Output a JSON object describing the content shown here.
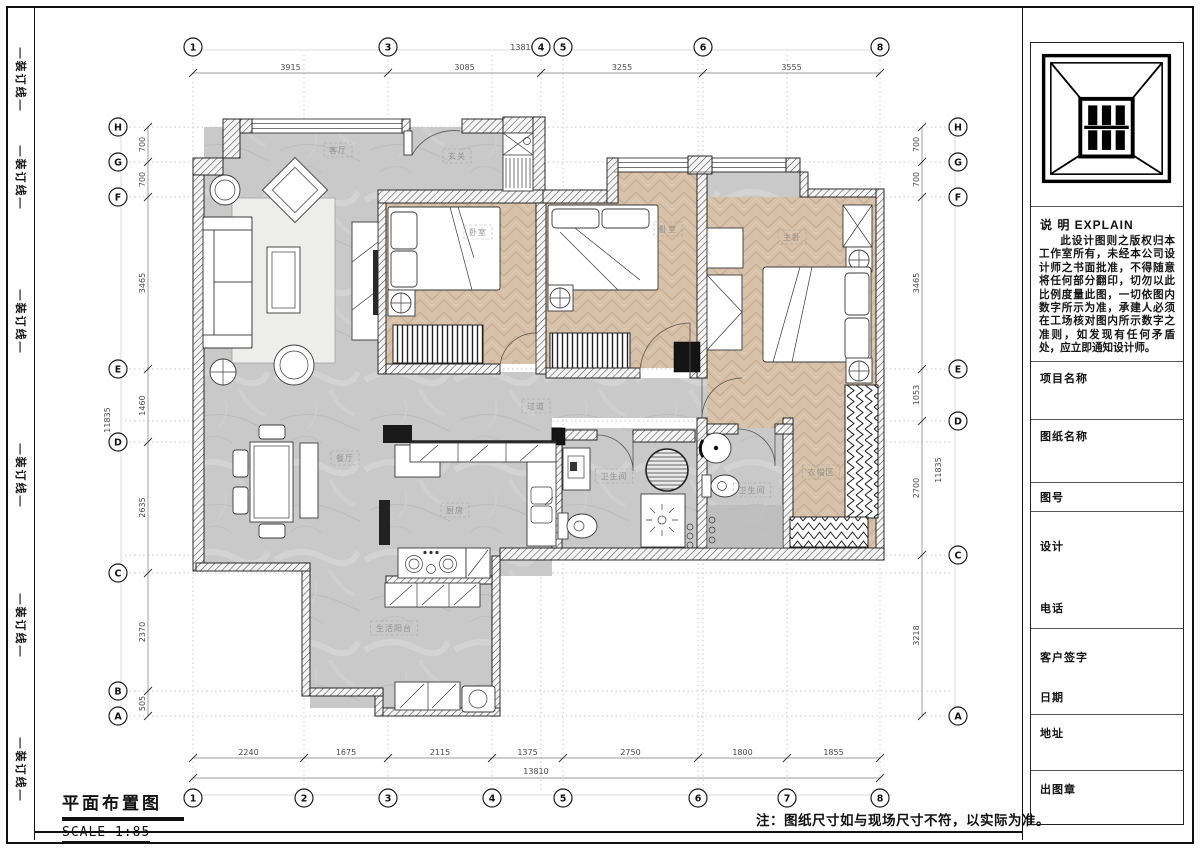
{
  "page": {
    "note": "注：图纸尺寸如与现场尺寸不符，以实际为准。"
  },
  "binding": {
    "label": "—装订线—",
    "positions_y": [
      80,
      178,
      322,
      476,
      626,
      770
    ]
  },
  "title_block": {
    "title": "平面布置图",
    "scale": "SCALE 1:85"
  },
  "panel": {
    "explain_title": "说 明 EXPLAIN",
    "explain_text": "此设计图则之版权归本工作室所有，未经本公司设计师之书面批准，不得随意将任何部分翻印，切勿以此比例度量此图，一切依图内数字所示为准，承建人必须在工场核对图内所示数字之准则，如发现有任何矛盾处，应立即通知设计师。",
    "fields": [
      "项目名称",
      "图纸名称",
      "图号",
      "设计",
      "电话",
      "客户签字",
      "日期",
      "地址",
      "出图章"
    ]
  },
  "plan": {
    "grid_v": [
      193,
      304,
      388,
      492,
      541,
      563,
      698,
      703,
      787,
      880
    ],
    "grid_v_span": [
      55,
      790
    ],
    "grid_h": [
      127,
      162,
      197,
      369,
      421,
      442,
      555,
      573,
      691,
      716
    ],
    "grid_h_span": [
      125,
      950
    ],
    "axis_lines": [
      {
        "x1": 183,
        "y1": 50,
        "x2": 892,
        "y2": 50
      },
      {
        "x1": 183,
        "y1": 795,
        "x2": 892,
        "y2": 795
      },
      {
        "x1": 121,
        "y1": 114,
        "x2": 121,
        "y2": 728
      },
      {
        "x1": 955,
        "y1": 114,
        "x2": 955,
        "y2": 728
      }
    ],
    "bubbles": [
      {
        "x": 193,
        "y": 47,
        "label": "1"
      },
      {
        "x": 388,
        "y": 47,
        "label": "3"
      },
      {
        "x": 541,
        "y": 47,
        "label": "4"
      },
      {
        "x": 563,
        "y": 47,
        "label": "5"
      },
      {
        "x": 703,
        "y": 47,
        "label": "6"
      },
      {
        "x": 880,
        "y": 47,
        "label": "8"
      },
      {
        "x": 193,
        "y": 798,
        "label": "1"
      },
      {
        "x": 304,
        "y": 798,
        "label": "2"
      },
      {
        "x": 388,
        "y": 798,
        "label": "3"
      },
      {
        "x": 492,
        "y": 798,
        "label": "4"
      },
      {
        "x": 563,
        "y": 798,
        "label": "5"
      },
      {
        "x": 698,
        "y": 798,
        "label": "6"
      },
      {
        "x": 787,
        "y": 798,
        "label": "7"
      },
      {
        "x": 880,
        "y": 798,
        "label": "8"
      },
      {
        "x": 118,
        "y": 127,
        "label": "H"
      },
      {
        "x": 118,
        "y": 162,
        "label": "G"
      },
      {
        "x": 118,
        "y": 197,
        "label": "F"
      },
      {
        "x": 118,
        "y": 369,
        "label": "E"
      },
      {
        "x": 118,
        "y": 442,
        "label": "D"
      },
      {
        "x": 118,
        "y": 573,
        "label": "C"
      },
      {
        "x": 118,
        "y": 691,
        "label": "B"
      },
      {
        "x": 118,
        "y": 716,
        "label": "A"
      },
      {
        "x": 958,
        "y": 127,
        "label": "H"
      },
      {
        "x": 958,
        "y": 162,
        "label": "G"
      },
      {
        "x": 958,
        "y": 197,
        "label": "F"
      },
      {
        "x": 958,
        "y": 369,
        "label": "E"
      },
      {
        "x": 958,
        "y": 421,
        "label": "D"
      },
      {
        "x": 958,
        "y": 555,
        "label": "C"
      },
      {
        "x": 958,
        "y": 716,
        "label": "A"
      }
    ],
    "dims": [
      {
        "orient": "h",
        "pos": 73,
        "bounds": [
          193,
          388,
          541,
          703,
          880
        ],
        "labels": [
          "3915",
          "3085",
          "3255",
          "3555"
        ]
      },
      {
        "orient": "h",
        "pos": 758,
        "bounds": [
          193,
          304,
          388,
          492,
          563,
          698,
          787,
          880
        ],
        "labels": [
          "2240",
          "1675",
          "2115",
          "1375",
          "2750",
          "1800",
          "1855"
        ]
      },
      {
        "orient": "h",
        "pos": 778,
        "bounds": [
          193,
          880
        ],
        "labels": [
          ""
        ]
      },
      {
        "orient": "v",
        "pos": 148,
        "bounds": [
          127,
          162,
          197,
          369,
          442,
          573,
          691,
          716
        ],
        "labels": [
          "700",
          "700",
          "3465",
          "1460",
          "2635",
          "2370",
          "505"
        ]
      },
      {
        "orient": "v",
        "pos": 922,
        "bounds": [
          127,
          162,
          197,
          369,
          421,
          555,
          716
        ],
        "labels": [
          "700",
          "700",
          "3465",
          "1053",
          "2700",
          "3218"
        ]
      }
    ],
    "totals": [
      {
        "text": "13810",
        "x": 523,
        "y": 50,
        "rot": 0
      },
      {
        "text": "13810",
        "x": 536,
        "y": 774,
        "rot": 0
      },
      {
        "text": "11835",
        "x": 110,
        "y": 420,
        "rot": -90
      },
      {
        "text": "11835",
        "x": 941,
        "y": 470,
        "rot": -90
      }
    ],
    "rooms": [
      {
        "name": "客厅",
        "x": 338,
        "y": 150
      },
      {
        "name": "玄关",
        "x": 457,
        "y": 156
      },
      {
        "name": "卧室",
        "x": 478,
        "y": 232
      },
      {
        "name": "卧室",
        "x": 668,
        "y": 229
      },
      {
        "name": "主卧",
        "x": 792,
        "y": 237
      },
      {
        "name": "餐厅",
        "x": 345,
        "y": 458
      },
      {
        "name": "厨房",
        "x": 455,
        "y": 510
      },
      {
        "name": "过道",
        "x": 536,
        "y": 406
      },
      {
        "name": "卫生间",
        "x": 614,
        "y": 476
      },
      {
        "name": "卫生间",
        "x": 752,
        "y": 490
      },
      {
        "name": "衣帽区",
        "x": 821,
        "y": 472
      },
      {
        "name": "生活阳台",
        "x": 394,
        "y": 628
      }
    ]
  }
}
